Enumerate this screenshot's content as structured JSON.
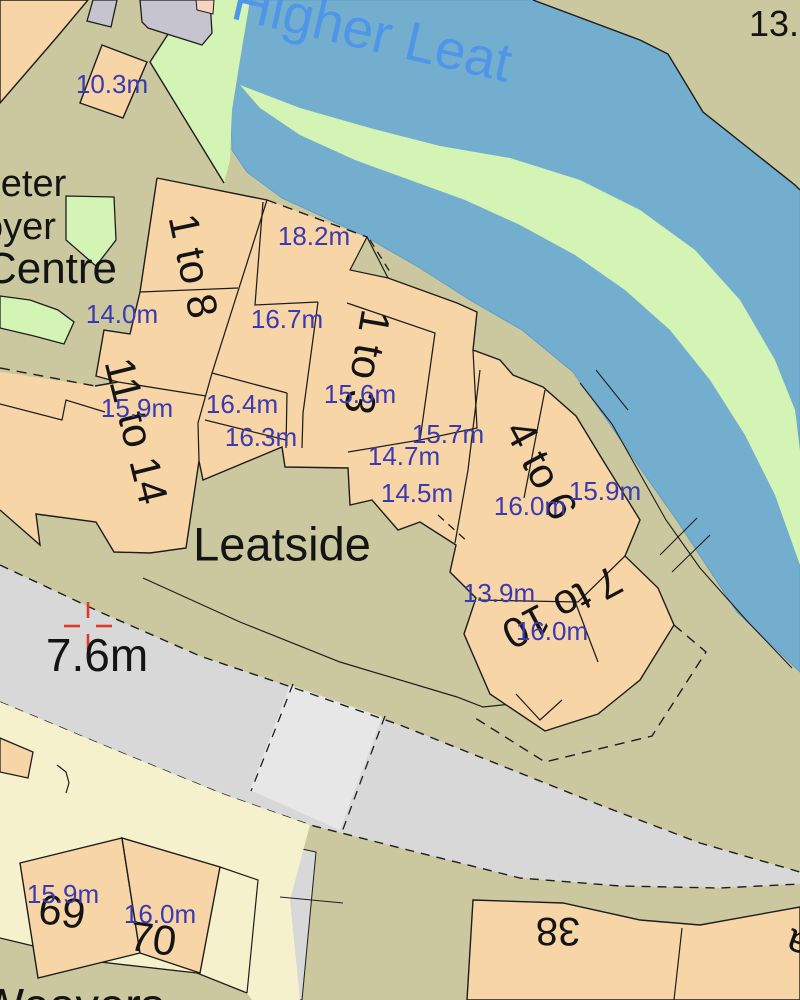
{
  "map": {
    "title": "OS large-scale map extract, Leatside / Higher Leat",
    "colors": {
      "land": "#cbc89f",
      "water": "#74aecf",
      "water_edge": "#5e9ec7",
      "bank_green": "#d3f4b4",
      "building": "#f8d5a7",
      "building_gray": "#c6c5cf",
      "building_pink": "#f8d2c2",
      "plot_cream": "#f6f1cd",
      "road": "#d8d8d8",
      "road_light": "#e7e7e7",
      "line": "#1d1d1d",
      "blue_label": "#3a3ab0",
      "water_label": "#4f96e8",
      "benchmark_red": "#e2382b"
    },
    "watercourse": {
      "name": "Higher Leat"
    },
    "street": {
      "name": "Leatside"
    },
    "labels": [
      {
        "kind": "water",
        "text": "Higher Leat",
        "x": 372,
        "y": 32,
        "rot": 13,
        "size": 55
      },
      {
        "kind": "name",
        "text": "13.",
        "x": 774,
        "y": 24,
        "rot": 0,
        "size": 36
      },
      {
        "kind": "name",
        "text": "xeter",
        "x": 24,
        "y": 184,
        "rot": 0,
        "size": 38
      },
      {
        "kind": "name",
        "text": "oyer",
        "x": 19,
        "y": 227,
        "rot": 0,
        "size": 38
      },
      {
        "kind": "name",
        "text": "Centre",
        "x": 51,
        "y": 269,
        "rot": 0,
        "size": 44
      },
      {
        "kind": "name",
        "text": "Leatside",
        "x": 282,
        "y": 544,
        "rot": 0,
        "size": 47
      },
      {
        "kind": "name",
        "text": "7.6m",
        "x": 97,
        "y": 655,
        "rot": 0,
        "size": 46
      },
      {
        "kind": "name",
        "text": "Weavers",
        "x": 72,
        "y": 1005,
        "rot": 0,
        "size": 47
      },
      {
        "kind": "bnum",
        "text": "1 to 8",
        "x": 193,
        "y": 266,
        "rot": 78,
        "size": 42
      },
      {
        "kind": "bnum",
        "text": "11 to 14",
        "x": 136,
        "y": 431,
        "rot": 76,
        "size": 42
      },
      {
        "kind": "bnum",
        "text": "1 to 3",
        "x": 367,
        "y": 362,
        "rot": 100,
        "size": 42
      },
      {
        "kind": "bnum",
        "text": "4 to 6",
        "x": 541,
        "y": 470,
        "rot": 62,
        "size": 42
      },
      {
        "kind": "bnum",
        "text": "7 to 10",
        "x": 562,
        "y": 607,
        "rot": 152,
        "size": 42
      },
      {
        "kind": "bnum",
        "text": "69",
        "x": 62,
        "y": 912,
        "rot": 8,
        "size": 42
      },
      {
        "kind": "bnum",
        "text": "70",
        "x": 153,
        "y": 939,
        "rot": 8,
        "size": 42
      },
      {
        "kind": "bnum",
        "text": "38",
        "x": 558,
        "y": 931,
        "rot": 180,
        "size": 40
      },
      {
        "kind": "bnum",
        "text": "a",
        "x": 798,
        "y": 944,
        "rot": 200,
        "size": 40
      },
      {
        "kind": "spot",
        "text": "10.3m",
        "x": 112,
        "y": 84,
        "rot": 0,
        "size": 26
      },
      {
        "kind": "spot",
        "text": "18.2m",
        "x": 314,
        "y": 236,
        "rot": 0,
        "size": 26
      },
      {
        "kind": "spot",
        "text": "16.7m",
        "x": 287,
        "y": 319,
        "rot": 0,
        "size": 26
      },
      {
        "kind": "spot",
        "text": "14.0m",
        "x": 122,
        "y": 314,
        "rot": 0,
        "size": 26
      },
      {
        "kind": "spot",
        "text": "15.9m",
        "x": 137,
        "y": 408,
        "rot": 0,
        "size": 26
      },
      {
        "kind": "spot",
        "text": "16.4m",
        "x": 242,
        "y": 404,
        "rot": 0,
        "size": 26
      },
      {
        "kind": "spot",
        "text": "16.3m",
        "x": 261,
        "y": 437,
        "rot": 0,
        "size": 26
      },
      {
        "kind": "spot",
        "text": "15.6m",
        "x": 360,
        "y": 394,
        "rot": 0,
        "size": 26
      },
      {
        "kind": "spot",
        "text": "14.7m",
        "x": 404,
        "y": 456,
        "rot": 0,
        "size": 26
      },
      {
        "kind": "spot",
        "text": "15.7m",
        "x": 448,
        "y": 434,
        "rot": 0,
        "size": 26
      },
      {
        "kind": "spot",
        "text": "14.5m",
        "x": 417,
        "y": 493,
        "rot": 0,
        "size": 26
      },
      {
        "kind": "spot",
        "text": "16.0m",
        "x": 530,
        "y": 506,
        "rot": 0,
        "size": 26
      },
      {
        "kind": "spot",
        "text": "15.9m",
        "x": 605,
        "y": 491,
        "rot": 0,
        "size": 26
      },
      {
        "kind": "spot",
        "text": "13.9m",
        "x": 499,
        "y": 593,
        "rot": 0,
        "size": 26
      },
      {
        "kind": "spot",
        "text": "16.0m",
        "x": 552,
        "y": 631,
        "rot": 0,
        "size": 26
      },
      {
        "kind": "spot",
        "text": "15.9m",
        "x": 63,
        "y": 894,
        "rot": 0,
        "size": 26
      },
      {
        "kind": "spot",
        "text": "16.0m",
        "x": 160,
        "y": 914,
        "rot": 0,
        "size": 26
      }
    ]
  }
}
